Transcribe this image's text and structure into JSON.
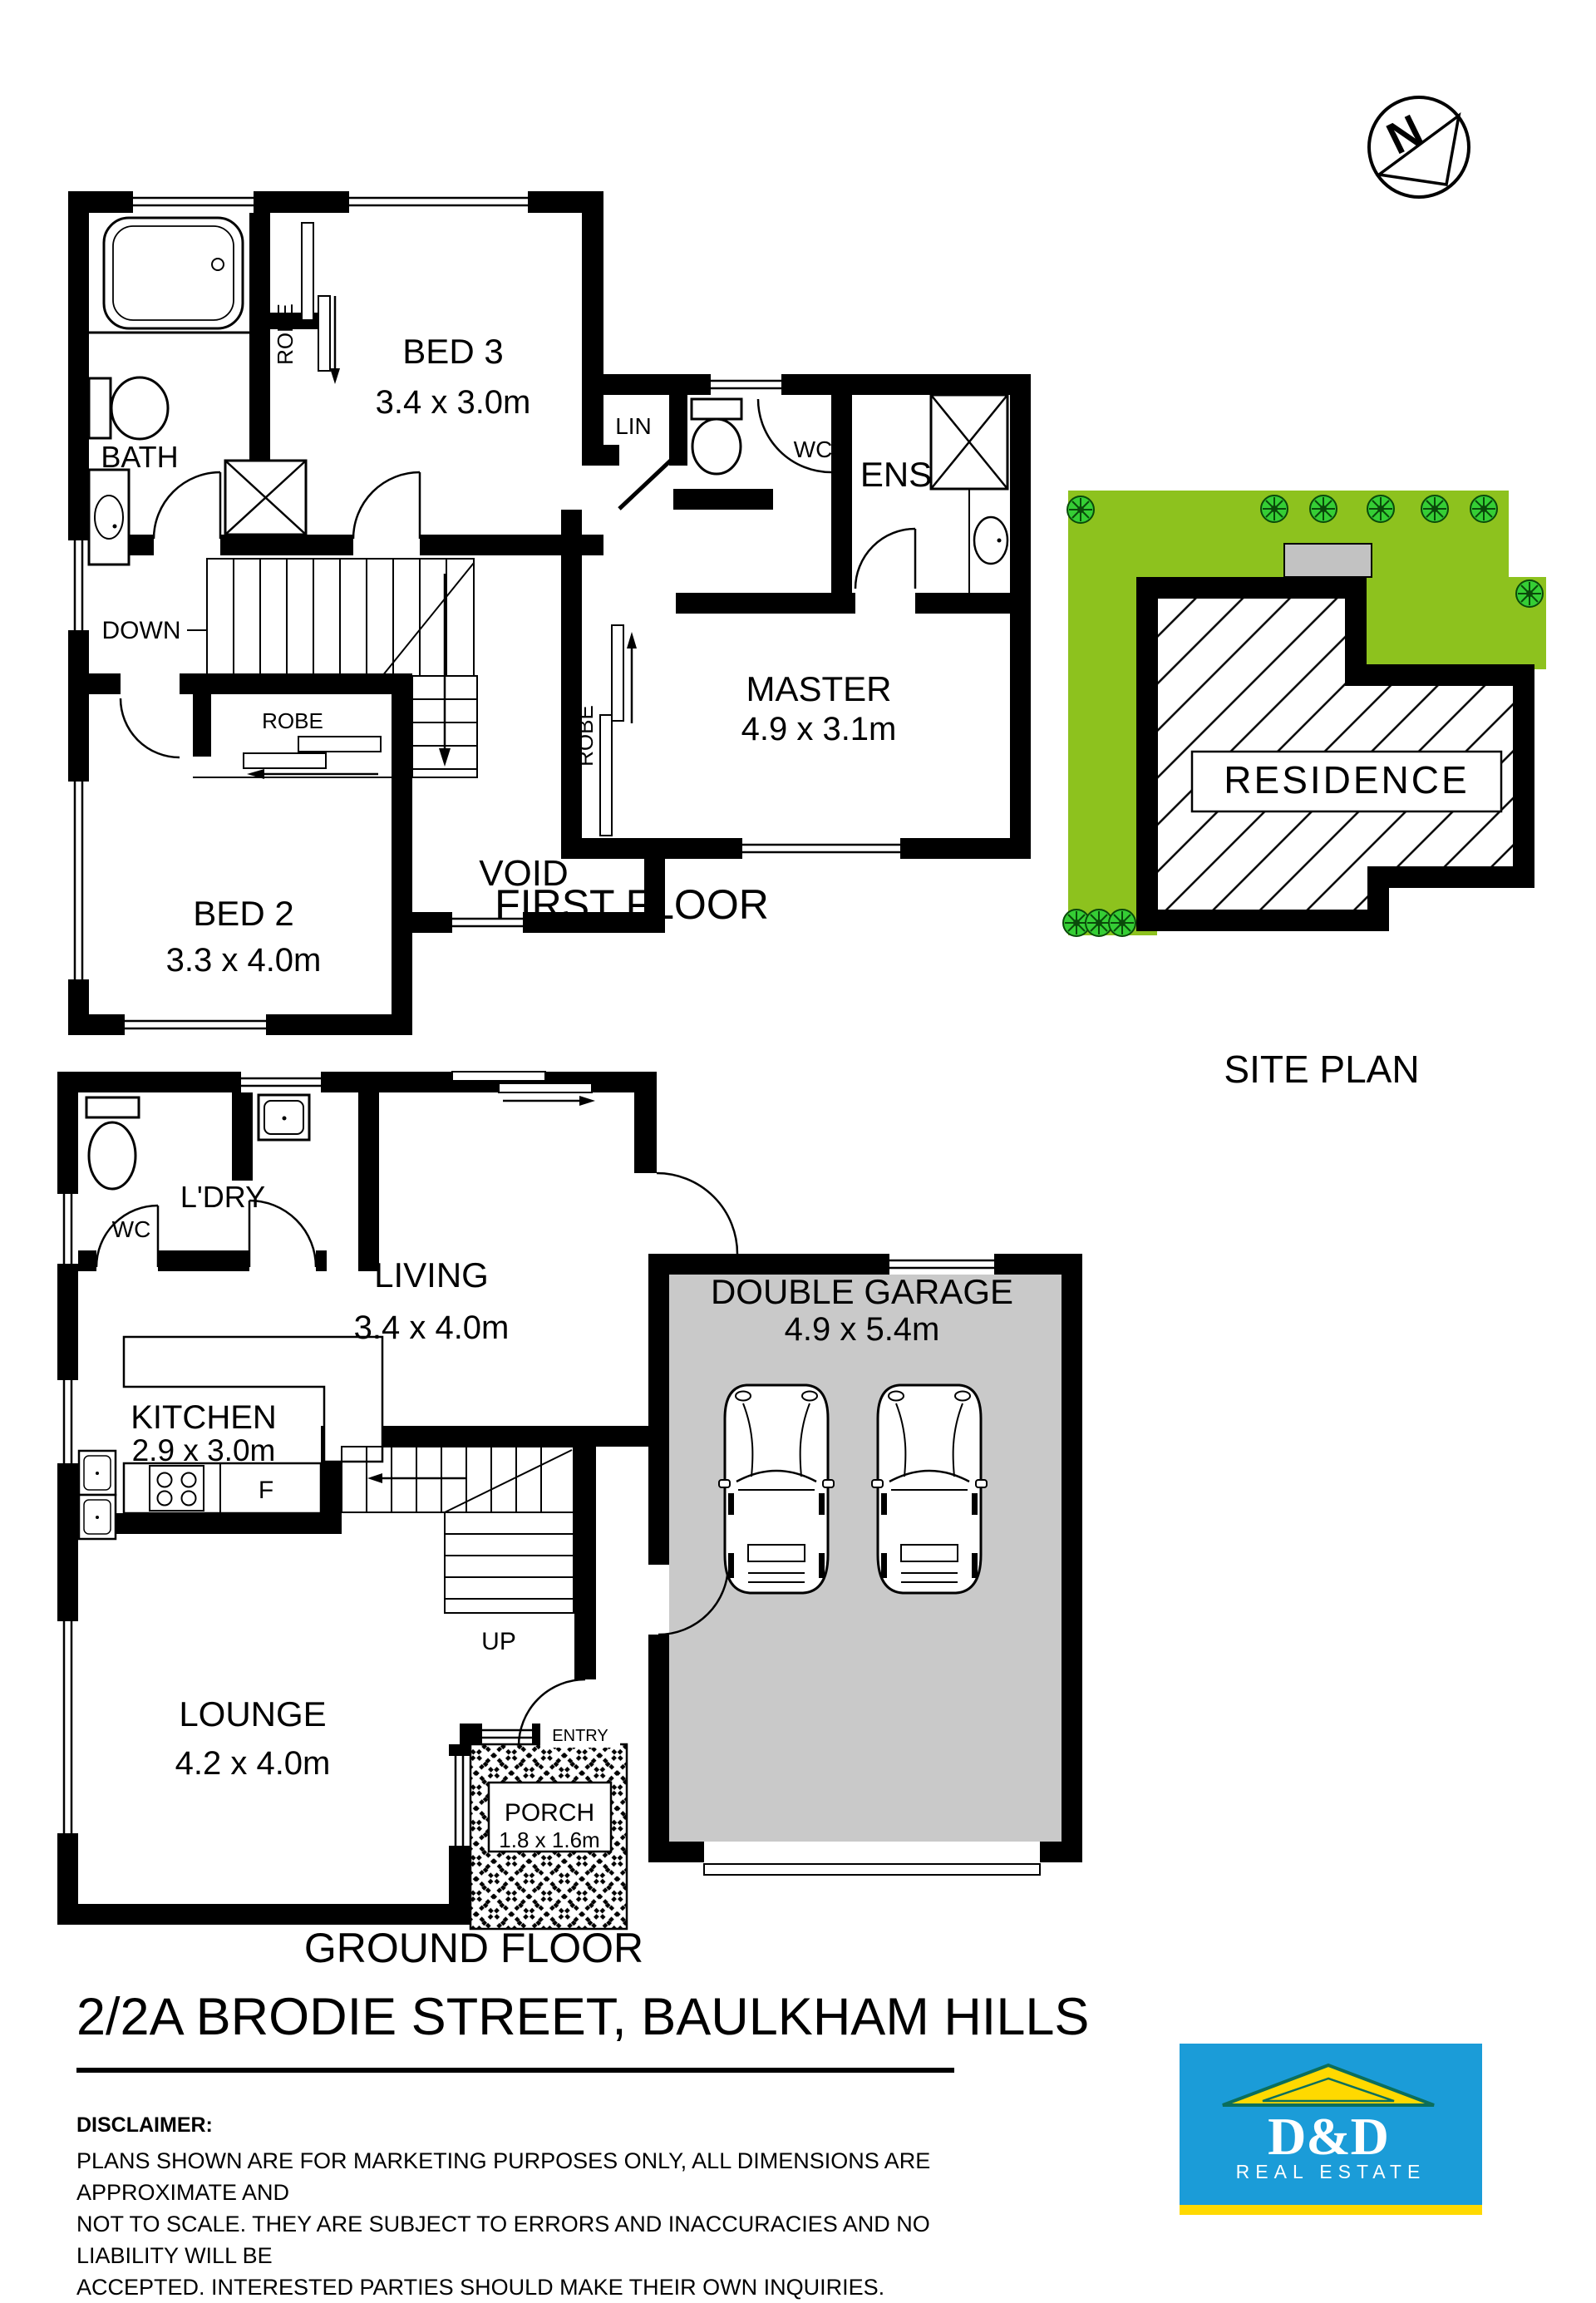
{
  "title": {
    "text": "2/2A BRODIE STREET, BAULKHAM HILLS"
  },
  "disclaimer": {
    "label": "DISCLAIMER:",
    "line1": "PLANS SHOWN ARE FOR MARKETING PURPOSES ONLY, ALL DIMENSIONS ARE APPROXIMATE AND",
    "line2": "NOT TO SCALE. THEY ARE SUBJECT TO ERRORS AND INACCURACIES AND NO LIABILITY WILL BE",
    "line3": "ACCEPTED. INTERESTED PARTIES SHOULD MAKE THEIR OWN INQUIRIES."
  },
  "logo": {
    "name": "D&D",
    "tagline": "REAL ESTATE"
  },
  "compass": {
    "letter": "N"
  },
  "colors": {
    "wall": "#000000",
    "site_green": "#8DC21E",
    "bush_green": "#35CE35",
    "garage_gray": "#C9C9C9",
    "driveway_gray": "#C2C2C2",
    "logo_blue": "#1B9CD8",
    "logo_yellow": "#FFD900",
    "roof_green": "#0B6E5C"
  },
  "first_floor": {
    "title": "FIRST FLOOR",
    "bed3": "BED 3",
    "bed3_dims": "3.4 x 3.0m",
    "bed2": "BED 2",
    "bed2_dims": "3.3 x 4.0m",
    "master": "MASTER",
    "master_dims": "4.9 x 3.1m",
    "bath": "BATH",
    "ens": "ENS",
    "wc": "WC",
    "lin": "LIN",
    "void": "VOID",
    "robe": "ROBE",
    "down": "DOWN"
  },
  "ground_floor": {
    "title": "GROUND FLOOR",
    "living": "LIVING",
    "living_dims": "3.4 x 4.0m",
    "kitchen": "KITCHEN",
    "kitchen_dims": "2.9 x 3.0m",
    "lounge": "LOUNGE",
    "lounge_dims": "4.2 x 4.0m",
    "garage": "DOUBLE GARAGE",
    "garage_dims": "4.9 x 5.4m",
    "porch": "PORCH",
    "porch_dims": "1.8 x 1.6m",
    "laundry": "L'DRY",
    "wc": "WC",
    "entry": "ENTRY",
    "up": "UP",
    "fridge": "F"
  },
  "site_plan": {
    "title": "SITE PLAN",
    "residence": "RESIDENCE"
  }
}
